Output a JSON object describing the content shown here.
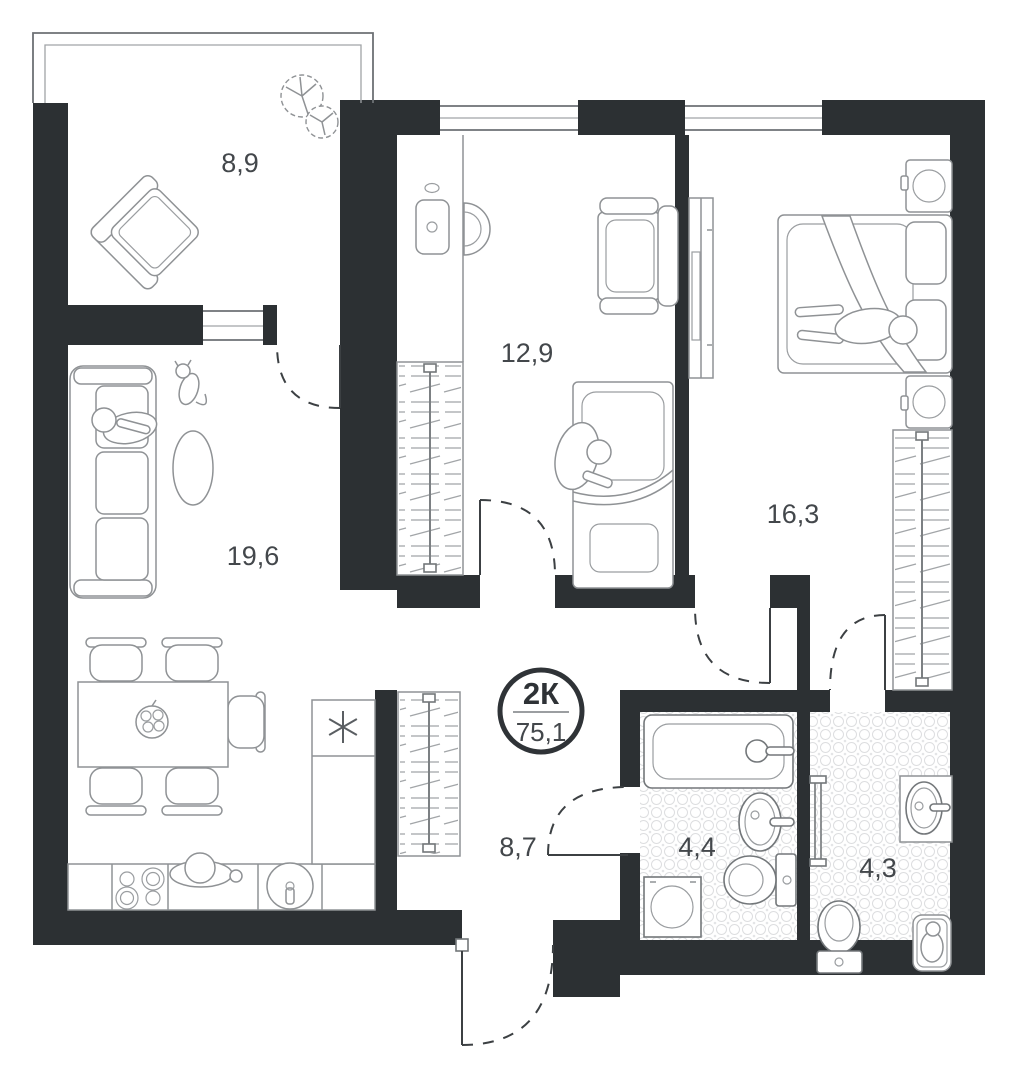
{
  "floorplan": {
    "badge": {
      "type_label": "2К",
      "total_area": "75,1"
    },
    "rooms": [
      {
        "name": "balcony",
        "area": "8,9"
      },
      {
        "name": "room",
        "area": "12,9"
      },
      {
        "name": "bedroom",
        "area": "16,3"
      },
      {
        "name": "living-room",
        "area": "19,6"
      },
      {
        "name": "hallway",
        "area": "8,7"
      },
      {
        "name": "bathroom",
        "area": "4,4"
      },
      {
        "name": "ensuite-bathroom",
        "area": "4,3"
      }
    ]
  }
}
